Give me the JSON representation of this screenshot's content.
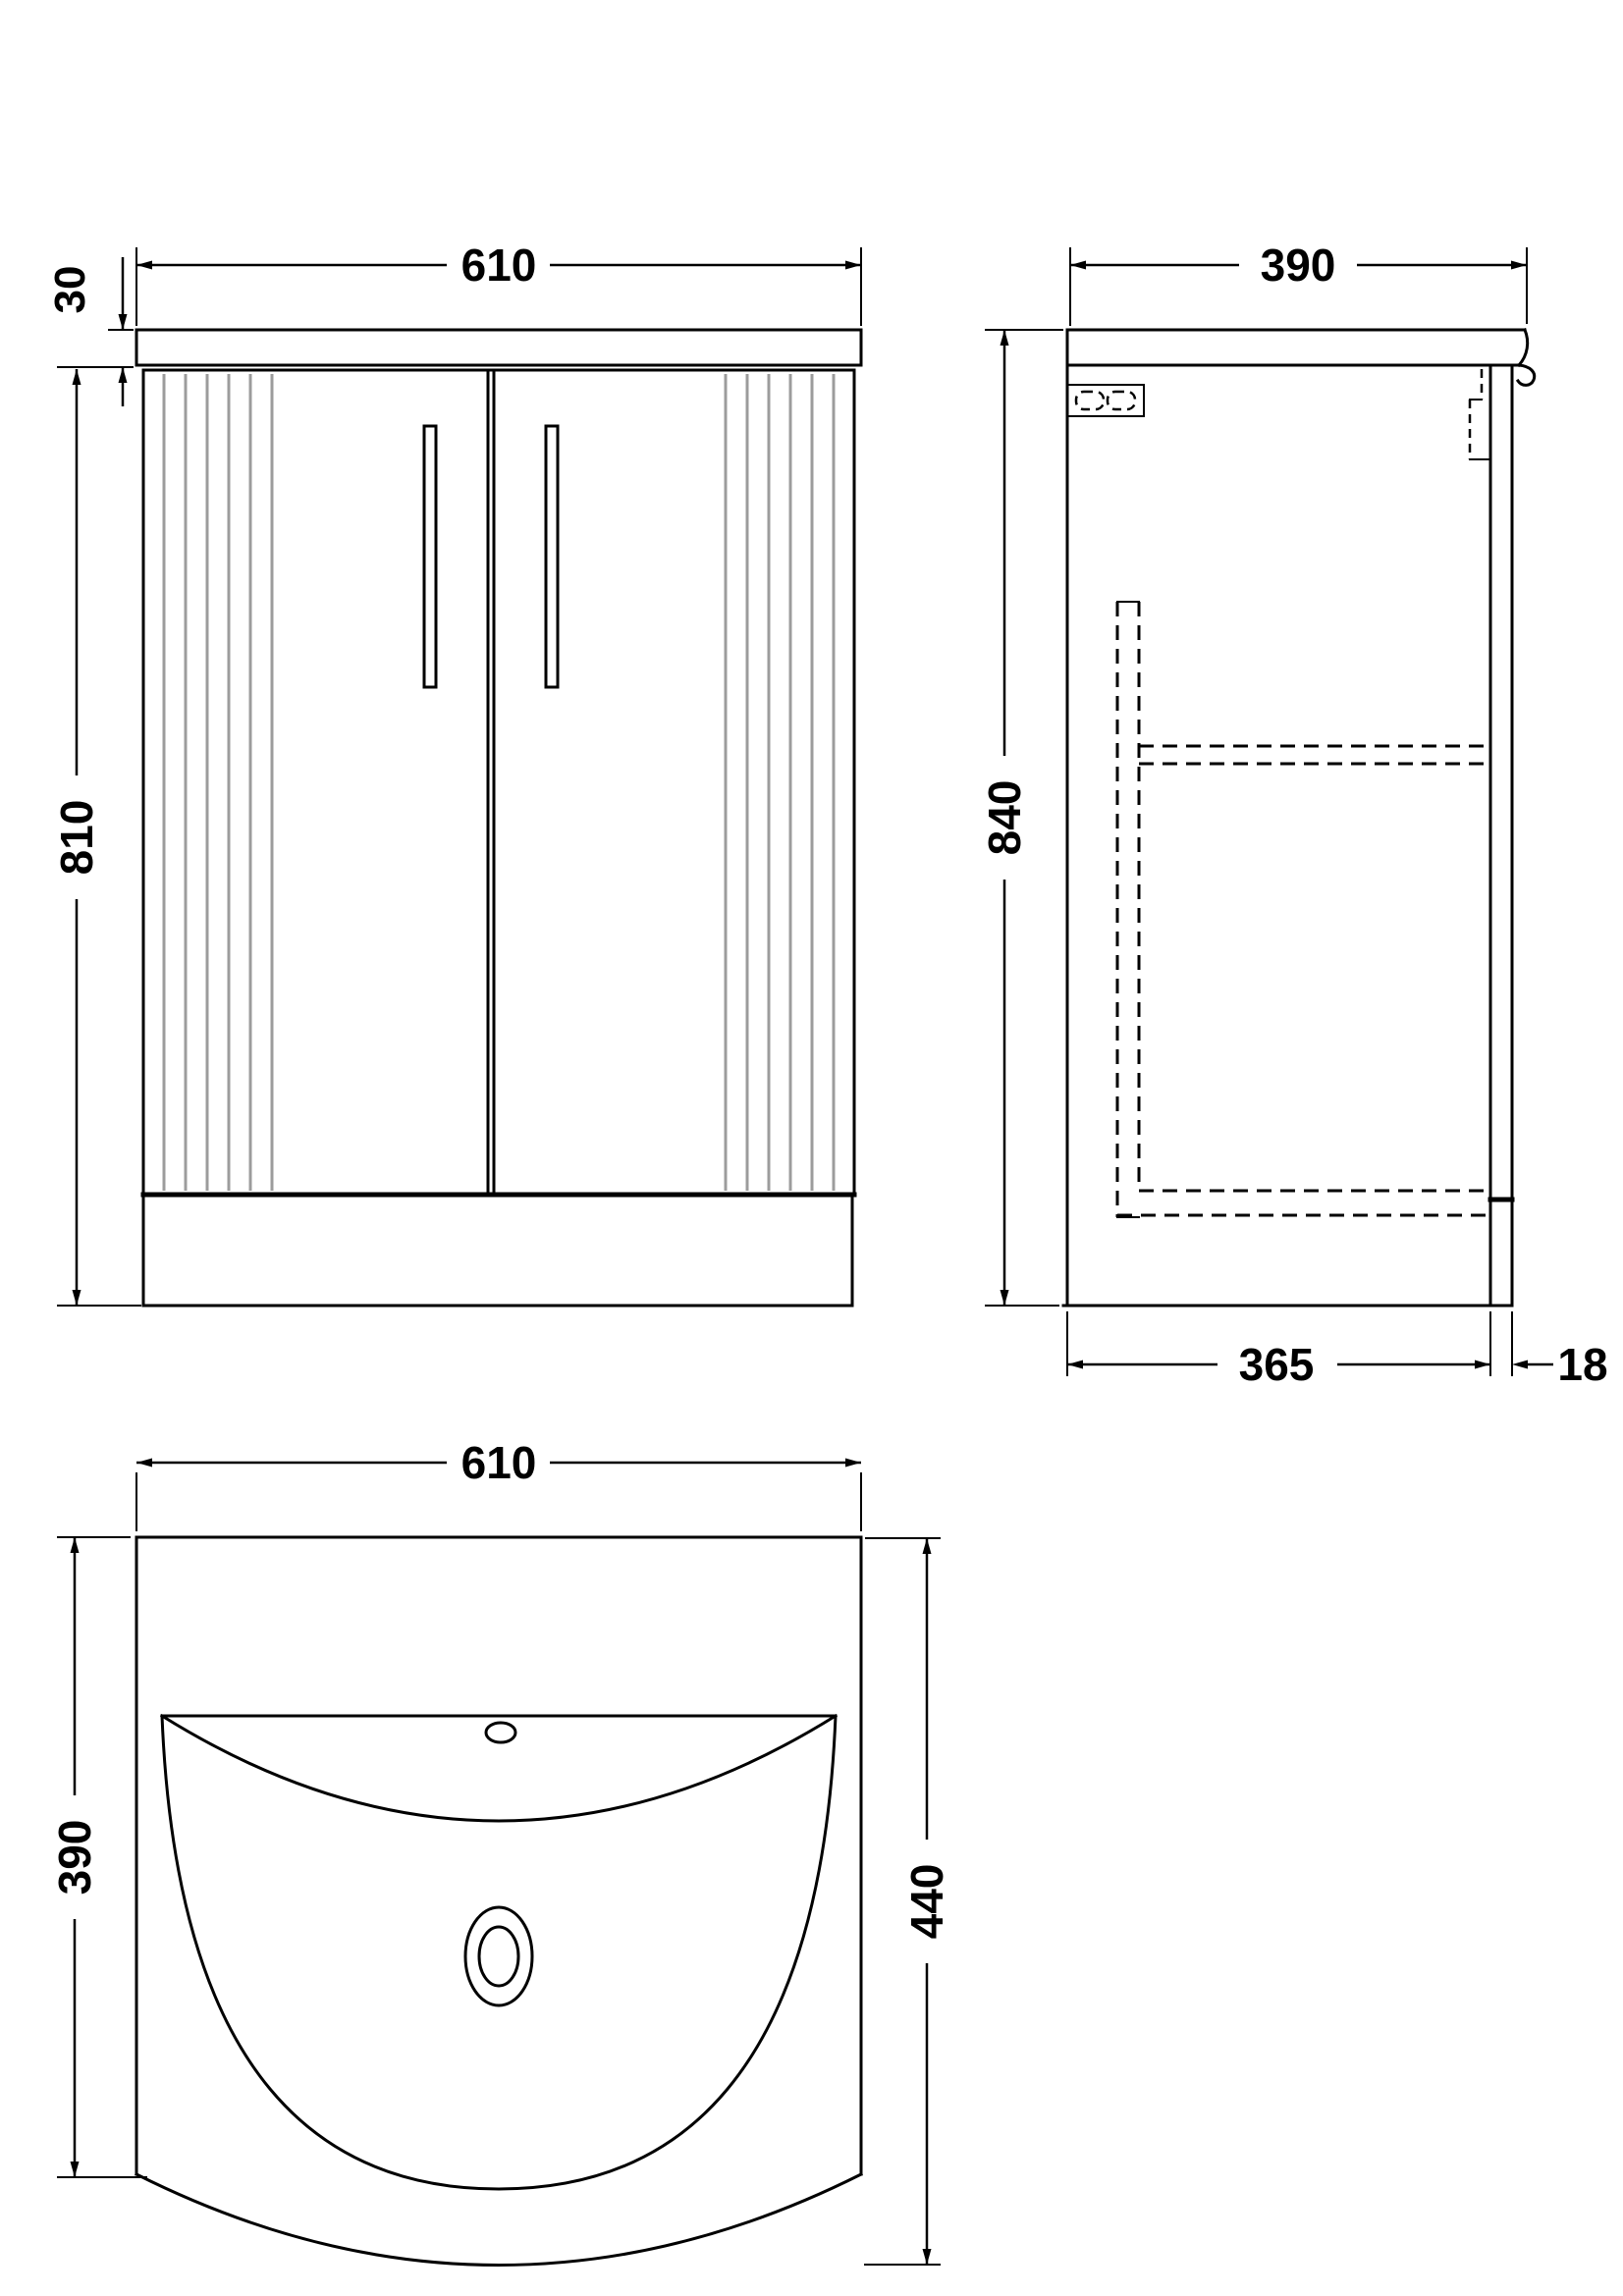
{
  "drawing": {
    "type": "technical-drawing",
    "subject": "vanity-unit-with-basin",
    "units": "mm",
    "colors": {
      "line": "#000000",
      "flute": "#9c9c9c",
      "background": "#ffffff"
    }
  },
  "views": {
    "front": {
      "label": "front elevation",
      "width": "610",
      "worktop_thickness": "30",
      "cabinet_height": "810"
    },
    "side": {
      "label": "side elevation",
      "depth": "390",
      "overall_height": "840",
      "carcass_depth": "365",
      "door_thickness": "18"
    },
    "plan": {
      "label": "basin plan",
      "width": "610",
      "bowl_depth": "390",
      "overall_depth": "440"
    }
  }
}
